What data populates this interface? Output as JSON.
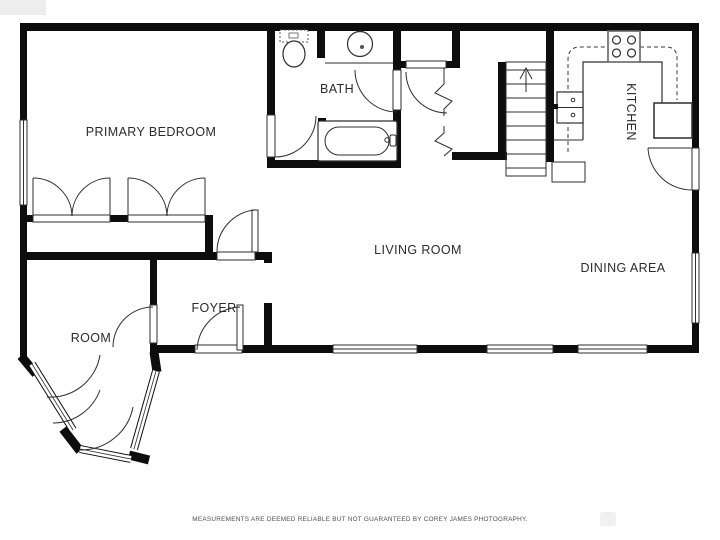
{
  "plan": {
    "labels": {
      "primary_bedroom": "PRIMARY BEDROOM",
      "bath": "BATH",
      "kitchen": "KITCHEN",
      "living_room": "LIVING ROOM",
      "dining_area": "DINING AREA",
      "foyer": "FOYER",
      "room": "ROOM"
    },
    "stairs": {
      "direction": "up"
    },
    "fixtures": [
      "toilet-icon",
      "bath-sink-icon",
      "bathtub-icon",
      "stove-icon",
      "kitchen-sink-icon",
      "refrigerator-icon",
      "stairs-up-icon",
      "closet-double-doors-icon",
      "window-icon",
      "door-swing-icon"
    ],
    "colors": {
      "wall": "#0d0d0d",
      "fixture_line": "#2e2e2e",
      "label_text": "#2b2b2b",
      "disclaimer_text": "#4f4f4f",
      "background": "#ffffff"
    }
  },
  "footer": {
    "disclaimer": "MEASUREMENTS ARE DEEMED RELIABLE BUT NOT GUARANTEED BY COREY JAMES PHOTOGRAPHY."
  }
}
